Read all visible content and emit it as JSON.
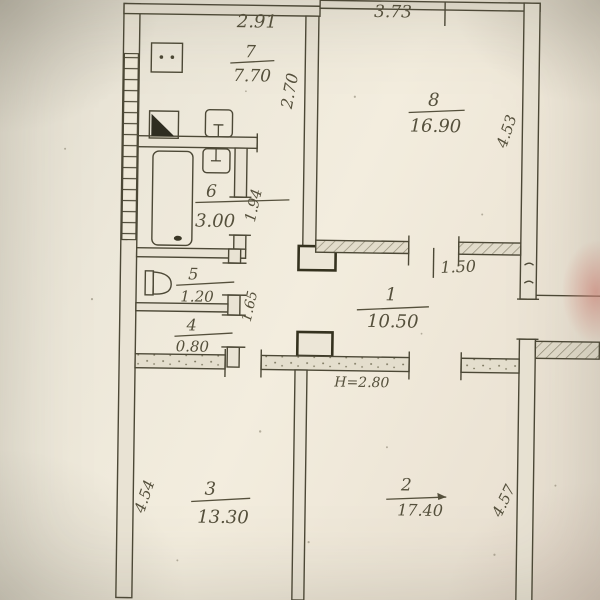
{
  "plan": {
    "rooms": [
      {
        "number": "7",
        "area": "7.70"
      },
      {
        "number": "8",
        "area": "16.90"
      },
      {
        "number": "6",
        "area": "3.00"
      },
      {
        "number": "5",
        "area": "1.20"
      },
      {
        "number": "4",
        "area": "0.80"
      },
      {
        "number": "1",
        "area": "10.50"
      },
      {
        "number": "3",
        "area": "13.30"
      },
      {
        "number": "2",
        "area": "17.40"
      }
    ],
    "dimensions": {
      "top_width": "2.91",
      "room8_width": "3.73",
      "kitchen_depth": "2.70",
      "room8_depth": "4.53",
      "bathroom_depth": "1.94",
      "closet_depth": "1.65",
      "opening_width": "1.50",
      "ceiling_height": "H=2.80",
      "room3_depth": "4.54",
      "room2_depth": "4.57"
    },
    "colors": {
      "paper": "#f0ead9",
      "ink": "#4c4836",
      "pencil": "#55503c"
    }
  }
}
